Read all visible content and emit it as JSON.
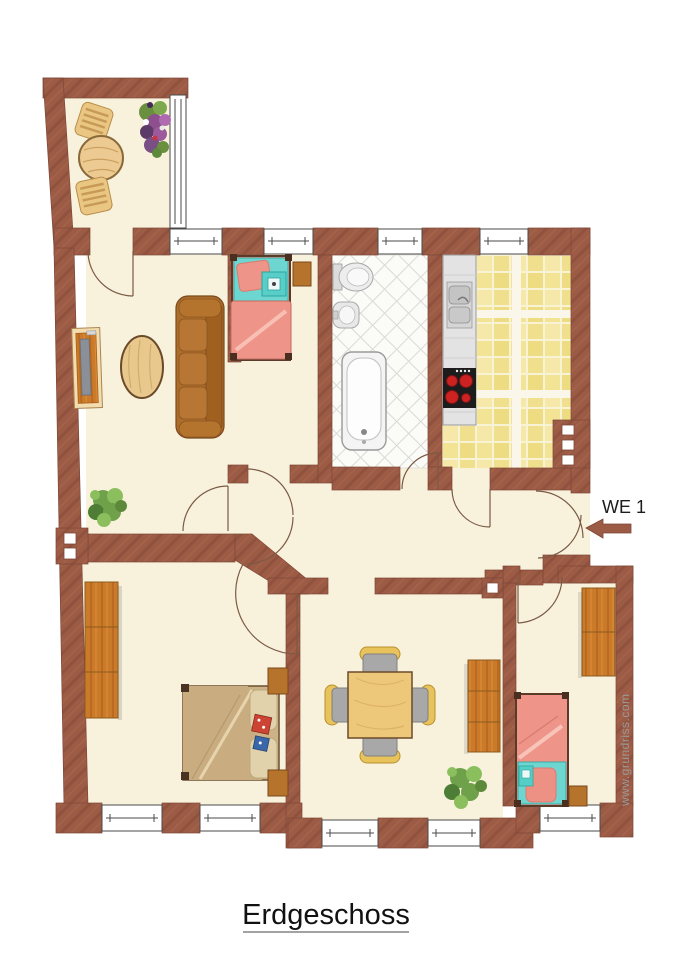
{
  "floor_title": "Erdgeschoss",
  "unit": {
    "label": "WE 1",
    "arrow_direction": "left"
  },
  "watermark": "www.grundriss.com",
  "colors": {
    "wall": "#9c5b45",
    "wall_line": "#7e4737",
    "floor_cream": "#f8f2dd",
    "kitchen_tile_light": "#f5e8a8",
    "kitchen_tile_dark": "#eedc82",
    "bath_tile_line": "#d9d9d4",
    "bed_linen_pink": "#ee9488",
    "bed_frame_teal": "#6ed6d0",
    "wood_orange": "#ca7a28",
    "sofa_brown": "#ad6c29",
    "double_bed_tan": "#cdb286",
    "dining_wood": "#edc87b",
    "chair_seat_gray": "#a8a8a8",
    "chair_back_tan": "#e8c25a",
    "plant_green": "#6fa04a",
    "label_text": "#1c1c1c",
    "watermark_gray": "#9a9a9a"
  }
}
